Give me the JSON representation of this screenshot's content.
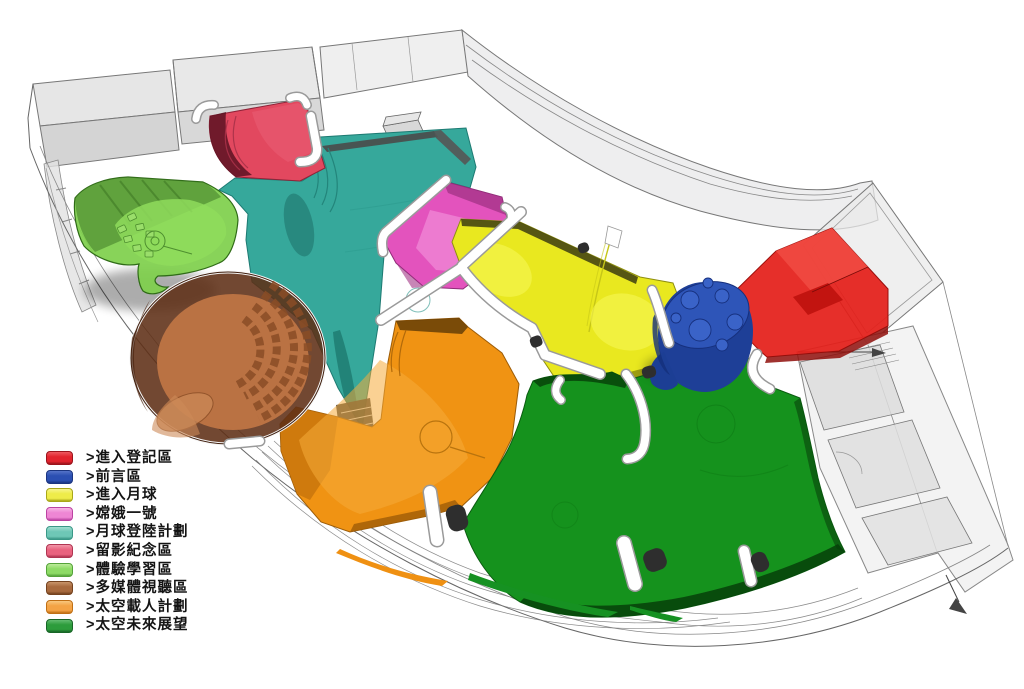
{
  "diagram": {
    "type": "exhibition-floor-plan-axonometric-3d",
    "background_color": "#ffffff",
    "wireframe_color": "#7d7d7d",
    "walkway_color": "#ffffff"
  },
  "legend": {
    "marker_shape": "3d-box-swatch",
    "items": [
      {
        "label": ">進入登記區",
        "name": "entry-registration-zone",
        "color": "#e2242e",
        "dark": "#9b141c",
        "light": "#ee5a60"
      },
      {
        "label": ">前言區",
        "name": "foreword-zone",
        "color": "#2b4fb2",
        "dark": "#1b3580",
        "light": "#5573c8"
      },
      {
        "label": ">進入月球",
        "name": "enter-the-moon-zone",
        "color": "#eeec49",
        "dark": "#a8a619",
        "light": "#f7f58c"
      },
      {
        "label": ">嫦娥一號",
        "name": "chang-e-1-zone",
        "color": "#ee86d4",
        "dark": "#bb43a2",
        "light": "#f7b6e6"
      },
      {
        "label": ">月球登陸計劃",
        "name": "lunar-landing-program-zone",
        "color": "#6ec7b6",
        "dark": "#3a9887",
        "light": "#a2ded1"
      },
      {
        "label": ">留影紀念區",
        "name": "photo-souvenir-zone",
        "color": "#e9637f",
        "dark": "#b03552",
        "light": "#f295a8"
      },
      {
        "label": ">體驗學習區",
        "name": "experiential-learning-zone",
        "color": "#8edb66",
        "dark": "#55a33a",
        "light": "#bdeb9a"
      },
      {
        "label": ">多媒體視聽區",
        "name": "multimedia-av-zone",
        "color": "#a86a3e",
        "dark": "#74421f",
        "light": "#c8946a"
      },
      {
        "label": ">太空載人計劃",
        "name": "manned-space-program-zone",
        "color": "#f4a345",
        "dark": "#c06f14",
        "light": "#f9c77e"
      },
      {
        "label": ">太空未來展望",
        "name": "space-future-outlook-zone",
        "color": "#2d9c3c",
        "dark": "#186627",
        "light": "#63bb70"
      }
    ]
  },
  "plan_zone_fills": {
    "photo_souvenir": "#e2485f",
    "lunar_landing": "#36a89b",
    "experiential_learning": "#7fd04c",
    "multimedia_av": "#ba7243",
    "chang_e_1": "#e353bd",
    "enter_the_moon": "#e9e81f",
    "foreword": "#2a4fae",
    "entry_registration": "#e41d18",
    "manned_space": "#f09313",
    "space_future": "#15921d"
  }
}
